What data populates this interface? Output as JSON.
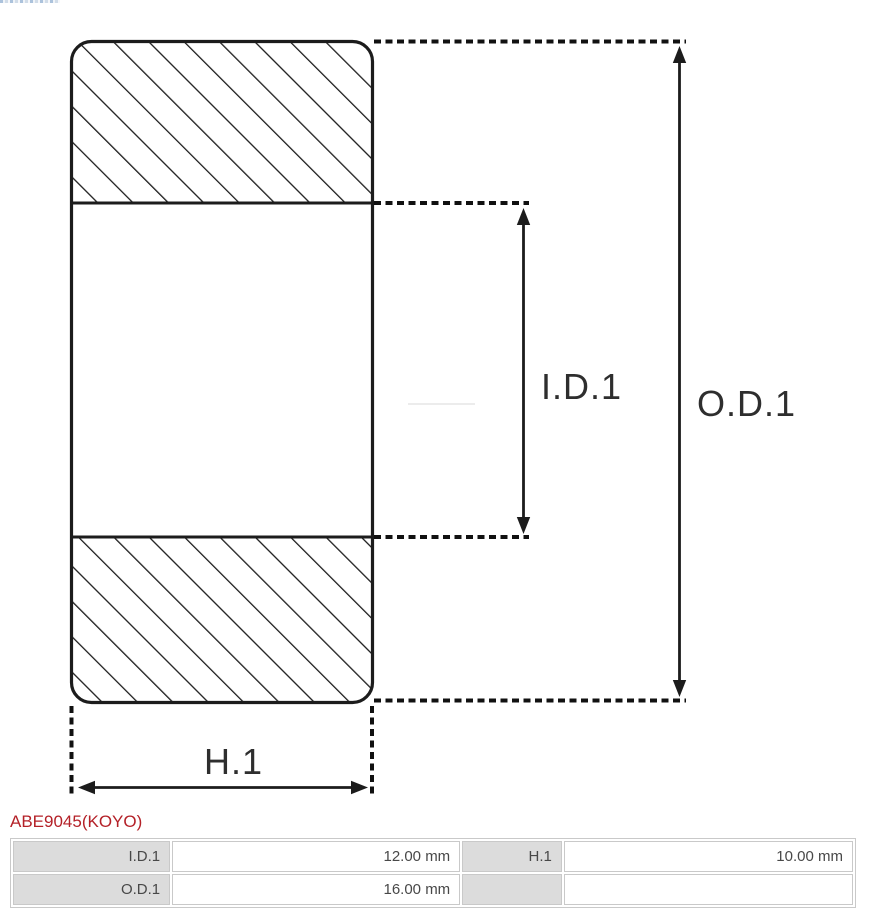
{
  "page": {
    "background": "#ffffff"
  },
  "diagram": {
    "type": "bearing-cross-section",
    "labels": {
      "inner_diameter": "I.D.1",
      "outer_diameter": "O.D.1",
      "height": "H.1"
    },
    "line_color": "#1c1c1c"
  },
  "part": {
    "number": "ABE9045(KOYO)",
    "accent_color": "#b42128"
  },
  "spec_table": {
    "rows": [
      {
        "label1": "I.D.1",
        "value1": "12.00 mm",
        "label2": "H.1",
        "value2": "10.00 mm"
      },
      {
        "label1": "O.D.1",
        "value1": "16.00 mm",
        "label2": "",
        "value2": ""
      }
    ]
  }
}
